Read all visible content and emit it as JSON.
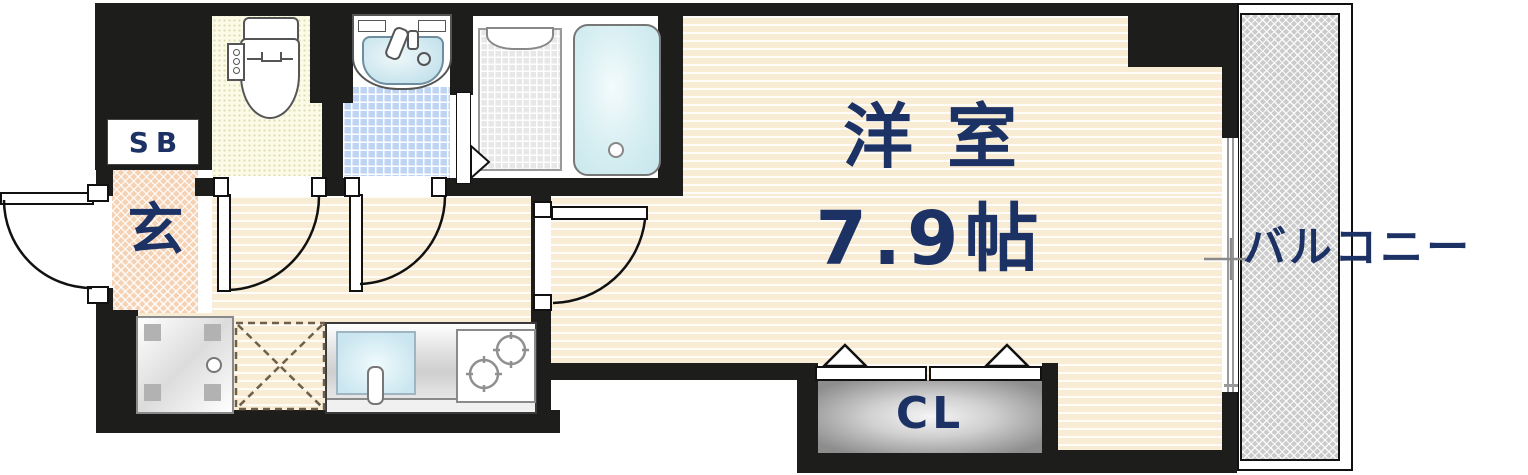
{
  "title": "apartment-floor-plan",
  "rooms": {
    "main_room": {
      "name": "洋室",
      "size": "7.9帖"
    },
    "entrance": {
      "label": "玄"
    },
    "shoe_box": {
      "label": "SB"
    },
    "closet": {
      "label": "CL"
    },
    "balcony": {
      "label": "バルコニー"
    }
  },
  "fixtures": [
    "toilet",
    "washbasin",
    "shower",
    "bathtub",
    "washing-machine-pan",
    "refrigerator-space",
    "kitchen-sink",
    "gas-stove",
    "entry-door",
    "toilet-door",
    "washroom-door",
    "main-room-door",
    "bathroom-folding-door",
    "closet-folding-door",
    "sliding-window"
  ],
  "colors": {
    "wall": "#1d1d1b",
    "room_floor": "#f9ecd4",
    "entrance_floor": "#f4d2b3",
    "toilet_floor": "#fbfbe7",
    "washroom_floor": "#bfd3f3",
    "shower_floor": "#e7e7e7",
    "balcony_floor": "#cbcbcb",
    "closet_fill": "#8d8d8d",
    "label_text": "#1c3264"
  }
}
